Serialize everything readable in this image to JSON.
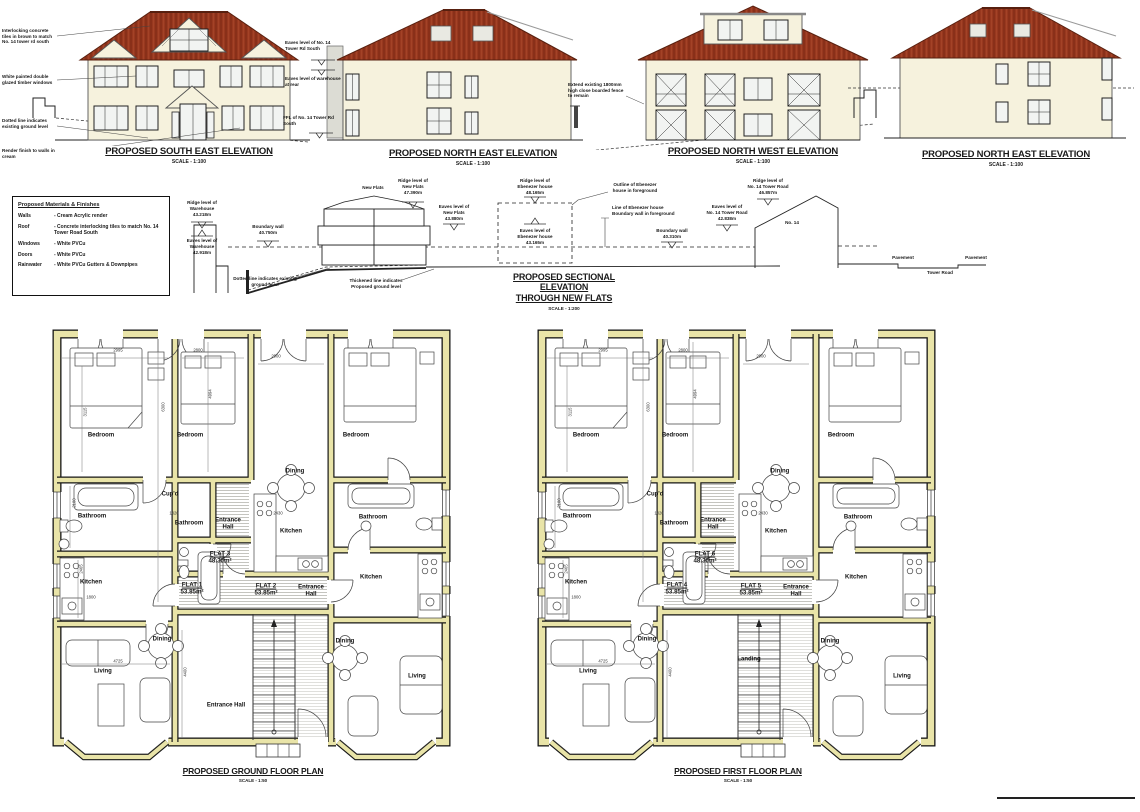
{
  "elevations": [
    {
      "title": "PROPOSED SOUTH EAST ELEVATION",
      "scale": "SCALE - 1:100",
      "note1": "Interlocking concrete tiles in brown to match No. 14 tower rd south",
      "note2": "White painted double glazed timber windows",
      "note3": "Dotted line indicates existing ground level",
      "note4": "Render finish to walls in cream"
    },
    {
      "title": "PROPOSED NORTH EAST ELEVATION",
      "scale": "SCALE - 1:100",
      "note1": "Eaves level of No. 14 Tower Rd South",
      "note2": "Eaves level of warehouse at rear",
      "note3": "FFL of No. 14 Tower Rd South"
    },
    {
      "title": "PROPOSED NORTH WEST ELEVATION",
      "scale": "SCALE - 1:100",
      "note1": "Extend existing 1800mm high close boarded fence to remain"
    },
    {
      "title": "PROPOSED NORTH EAST ELEVATION",
      "scale": "SCALE - 1:100"
    }
  ],
  "legend": {
    "title": "Proposed Materials & Finishes",
    "rows": [
      {
        "item": "Walls",
        "value": "- Cream Acrylic render"
      },
      {
        "item": "Roof",
        "value": "- Concrete interlocking tiles to match No. 14 Tower Road South"
      },
      {
        "item": "Windows",
        "value": "- White PVCu"
      },
      {
        "item": "Doors",
        "value": "- White PVCu"
      },
      {
        "item": "Rainwater",
        "value": "- White PVCu Gutters & Downpipes"
      }
    ]
  },
  "section": {
    "title_line1": "PROPOSED SECTIONAL ELEVATION",
    "title_line2": "THROUGH NEW FLATS",
    "scale": "SCALE - 1:200",
    "new_flats": "New Flats",
    "ridge_warehouse": "Ridge level of\nWarehouse\n43.218m",
    "eaves_warehouse": "Eaves level of\nWarehouse\n42.918m",
    "boundary_wall_left": "Boundary wall\n40.750m",
    "ridge_flats": "Ridge level of\nNew Flats\n47.390m",
    "eaves_flats": "Eaves level of\nNew Flats\n43.880m",
    "ridge_ebenezer": "Ridge level of\nEbenezer house\n48.165m",
    "eaves_ebenezer": "Eaves level of\nEbenezer house\n43.165m",
    "outline_ebenezer": "Outline of Ebenezer\nhouse in foreground",
    "line_ebenezer": "Line of Ebenezer house\nBoundary wall in foreground",
    "boundary_wall_right": "Boundary wall\n40.310m",
    "eaves_no14": "Eaves level of\nNo. 14 Tower Road\n42.838m",
    "ridge_no14": "Ridge level of\nNo. 14 Tower Road\n46.857m",
    "no14": "No. 14",
    "pavement1": "Pavement",
    "tower_road": "Tower Road",
    "pavement2": "Pavement",
    "note_existing": "Dotted line indicates existing\nground level",
    "note_proposed": "Thickened line indicates\nProposed ground level"
  },
  "plans": [
    {
      "title": "PROPOSED GROUND FLOOR PLAN",
      "scale": "SCALE - 1:50",
      "rooms": {
        "bedroom_left": "Bedroom",
        "bedroom_mid": "Bedroom",
        "bedroom_right": "Bedroom",
        "cupd": "Cup'd",
        "bath_left": "Bathroom",
        "bath_mid": "Bathroom",
        "bath_right": "Bathroom",
        "kitchen_left": "Kitchen",
        "kitchen_mid": "Kitchen",
        "kitchen_right": "Kitchen",
        "dining_left": "Dining",
        "dining_mid": "Dining",
        "dining_right": "Dining",
        "living_left": "Living",
        "living_right": "Living",
        "hall_mid": "Entrance\nHall",
        "hall_right": "Entrance\nHall",
        "hall_main": "Entrance Hall"
      },
      "flats": [
        {
          "name": "FLAT 1",
          "area": "53.85m²"
        },
        {
          "name": "FLAT 2",
          "area": "53.85m²"
        },
        {
          "name": "FLAT 3",
          "area": "48.30m²"
        }
      ]
    },
    {
      "title": "PROPOSED FIRST FLOOR PLAN",
      "scale": "SCALE - 1:50",
      "rooms": {
        "bedroom_left": "Bedroom",
        "bedroom_mid": "Bedroom",
        "bedroom_right": "Bedroom",
        "cupd": "Cup'd",
        "bath_left": "Bathroom",
        "bath_mid": "Bathroom",
        "bath_right": "Bathroom",
        "kitchen_left": "Kitchen",
        "kitchen_mid": "Kitchen",
        "kitchen_right": "Kitchen",
        "dining_left": "Dining",
        "dining_mid": "Dining",
        "dining_right": "Dining",
        "living_left": "Living",
        "living_right": "Living",
        "hall_mid": "Entrance\nHall",
        "hall_right": "Entrance\nHall",
        "hall_main": "Landing"
      },
      "flats": [
        {
          "name": "FLAT 4",
          "area": "53.85m²"
        },
        {
          "name": "FLAT 5",
          "area": "53.85m²"
        },
        {
          "name": "FLAT 6",
          "area": "48.30m²"
        }
      ]
    }
  ],
  "dims": {
    "top_left": "2995",
    "top_mid": "2800",
    "top_right": "2900",
    "vert_left": "3115",
    "vert_mid": "6300",
    "vert_mid2": "4994",
    "bath": "1820",
    "kitchen": "2430",
    "bath_v": "2100",
    "kitchen_v": "2465",
    "kitchen_w": "1800",
    "living_w": "4725",
    "living_h": "4400"
  }
}
